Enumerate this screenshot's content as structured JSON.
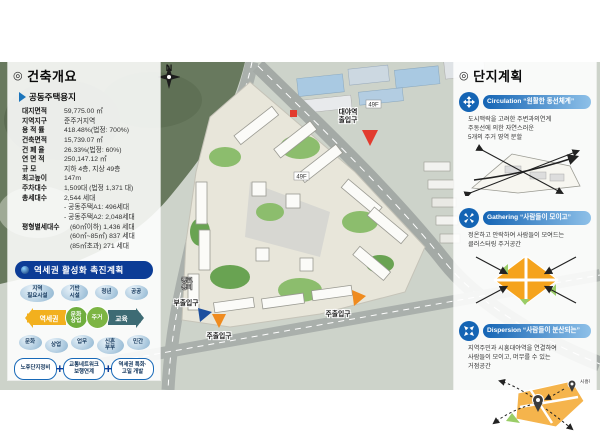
{
  "overview": {
    "icon": "◎",
    "title": "건축개요",
    "subtitle_icon": "▶",
    "subtitle": "공동주택용지",
    "rows": [
      {
        "label": "대지면적",
        "value": "59,775.00 ㎡"
      },
      {
        "label": "지역지구",
        "value": "준주거지역"
      },
      {
        "label": "용 적 률",
        "value": "418.48%(법정: 700%)"
      },
      {
        "label": "건축면적",
        "value": "15,739.07 ㎡"
      },
      {
        "label": "건 폐 율",
        "value": "26.33%(법정: 60%)"
      },
      {
        "label": "연 면 적",
        "value": "250,147.12 ㎡"
      },
      {
        "label": "규    모",
        "value": "지하 4층, 지상 49층"
      },
      {
        "label": "최고높이",
        "value": "147m"
      },
      {
        "label": "주차대수",
        "value": "1,509대 (법정 1,371 대)"
      },
      {
        "label": "총세대수",
        "value": "2,544 세대"
      }
    ],
    "units": [
      "- 공동주택A1: 496세대",
      "- 공동주택A2: 2,048세대"
    ],
    "size_label": "평형별세대수",
    "sizes": [
      "(60㎡이하) 1,436 세대",
      "(60㎡~85㎡) 837 세대",
      "(85㎡초과) 271 세대"
    ]
  },
  "station_plan": {
    "title": "역세권 활성화 촉진계획",
    "top_bubbles": [
      "지역\n필요시설",
      "기반\n시설",
      "청년",
      "공공"
    ],
    "flow": {
      "start": "역세권",
      "mid1": "문화\n상업",
      "mid2": "주거",
      "end": "교육"
    },
    "bottom_bubbles": [
      "문화",
      "상업",
      "업무",
      "신혼\n부부",
      "민간"
    ],
    "strategy_boxes": [
      "노후단지정비",
      "교통네트워크\n보행연계",
      "역세권 특화·\n고밀 개발"
    ],
    "plus": "+"
  },
  "site_plan": {
    "icon": "◎",
    "title": "단지계획",
    "sections": [
      {
        "en": "Circulation",
        "quote": "“원활한 동선체계”",
        "desc": "도시맥락을 고려한 주변과의연계\n주동선에 의한 자연스러운\n5개의 주거 영역 분할"
      },
      {
        "en": "Gathering",
        "quote": "“사람들이 모이고”",
        "desc": "정온하고 안락하여 사람들이 모여드는\n클러스터링 주거공간"
      },
      {
        "en": "Dispersion",
        "quote": "“사람들이 분산되는”",
        "desc": "지역주민과 시흥대야역을 연결하여\n사람들이 모이고, 머무를 수 있는\n거점공간",
        "fig_label": "시흥대야역"
      }
    ]
  },
  "map": {
    "north": "N",
    "station_exit_line1": "대야역",
    "station_exit_line2": "출입구",
    "main_entrance": "주출입구",
    "sub_entrance": "부출입구",
    "religious_line1": "종교",
    "religious_line2": "용지",
    "floor_tag": "49F"
  },
  "colors": {
    "accent_navy": "#0c3c96",
    "accent_blue": "#1464b4",
    "flow_yellow": "#f2b01e",
    "flow_green": "#7ab648",
    "flow_teal": "#3d6b74",
    "marker_red": "#e23b2e",
    "marker_orange": "#ef8b1f",
    "marker_blue": "#1d4f9e"
  }
}
